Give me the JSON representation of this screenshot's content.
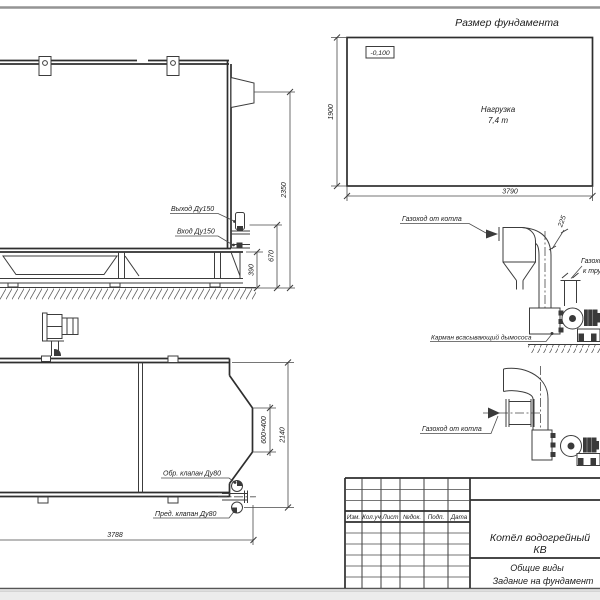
{
  "foundation_plan": {
    "title": "Размер фундамента",
    "elevation_mark": "-0,100",
    "load_line1": "Нагрузка",
    "load_line2": "7,4 т",
    "dim_width": "1900",
    "dim_length": "3790"
  },
  "side_view": {
    "label_outlet": "Выход Ду150",
    "label_inlet": "Вход Ду150",
    "dim_total_height": "2350",
    "dim_outlet_height": "670",
    "dim_inlet_height": "390"
  },
  "plan_view": {
    "label_check_valve": "Обр. клапан Ду80",
    "label_safety_valve": "Пред. клапан Ду80",
    "dim_length": "3788",
    "dim_width": "2140",
    "dim_flue_section": "600×400"
  },
  "flue_diagram_cyclone": {
    "label_from_boiler": "Газоход от котла",
    "dim_duct": "225",
    "label_to_stack_line1": "Газоход",
    "label_to_stack_line2": "к трубе",
    "label_pocket": "Карман всасывающий дымососа"
  },
  "flue_diagram_simple": {
    "label_from_boiler": "Газоход от котла"
  },
  "title_block": {
    "columns": [
      "Изм.",
      "Кол.уч",
      "Лист",
      "№док.",
      "Подп.",
      "Дата"
    ],
    "product_name_line1": "Котёл водогрейный",
    "product_name_line2": "КВ",
    "doc_type_line1": "Общие виды",
    "doc_type_line2": "Задание на фундамент"
  },
  "colors": {
    "line": "#3c3c3c",
    "sheet": "#ffffff",
    "margin": "#ececec"
  }
}
